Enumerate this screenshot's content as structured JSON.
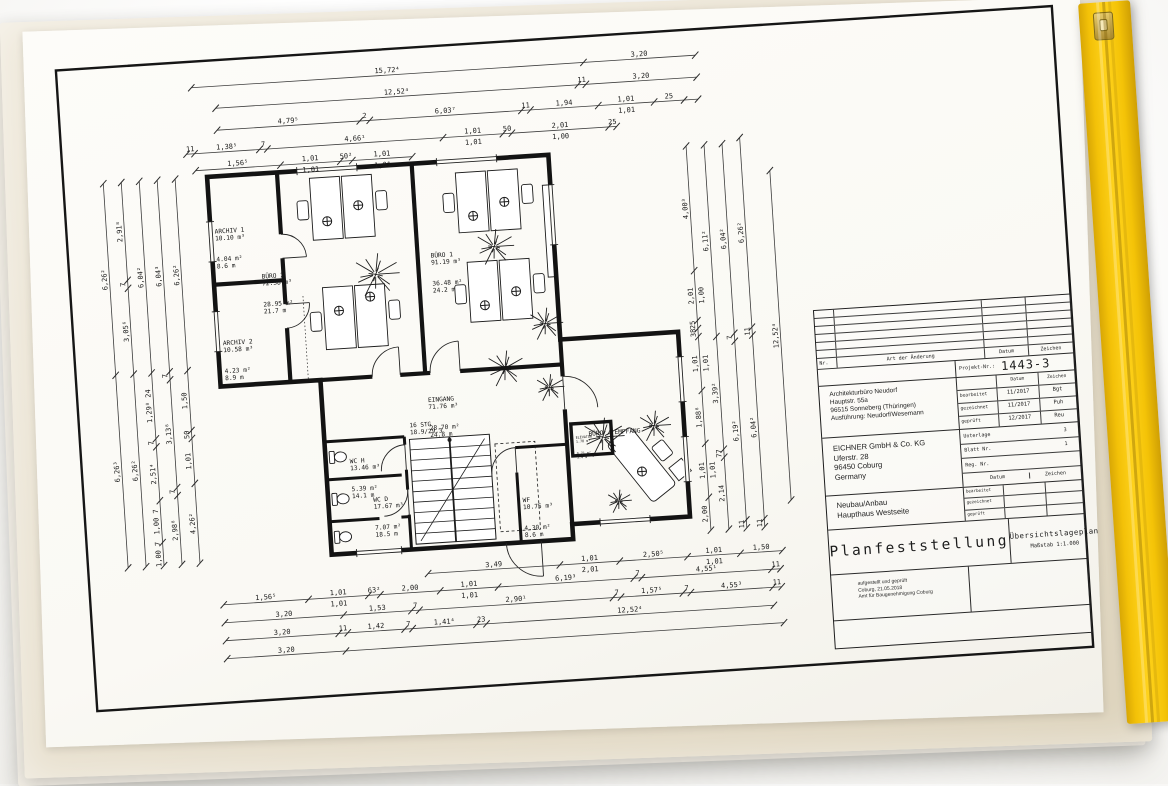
{
  "photo": {
    "background_color": "#ffffff",
    "sleeve_color": "#e7dfcd",
    "sheet_color": "#fbfaf6",
    "binder_strip_color": "#f5c408",
    "line_color": "#1c1c1c"
  },
  "rooms": {
    "archiv1": {
      "lines": [
        "ARCHIV 1",
        "10.10 m³",
        "4.04 m²",
        "8.6 m"
      ]
    },
    "buero2": {
      "lines": [
        "BÜRO 2",
        "72.38 m³",
        "28.95 m²",
        "21.7 m"
      ]
    },
    "archiv2": {
      "lines": [
        "ARCHIV 2",
        "10.58 m³",
        "4.23 m²",
        "8.9 m"
      ]
    },
    "buero1": {
      "lines": [
        "BÜRO 1",
        "91.19 m³",
        "36.48 m²",
        "24.2 m"
      ]
    },
    "eingang": {
      "lines": [
        "EINGANG",
        "71.76 m³",
        "28.70 m²",
        "24.8 m"
      ]
    },
    "wch": {
      "lines": [
        "WC H",
        "13.46 m³",
        "5.39 m²",
        "14.1 m"
      ]
    },
    "wcd": {
      "lines": [
        "WC D",
        "17.67 m³",
        "7.07 m²",
        "18.5 m"
      ]
    },
    "wf": {
      "lines": [
        "WF",
        "10.75 m³",
        "4.30 m²",
        "8.6 m"
      ]
    },
    "empfang": {
      "lines": [
        "BÜRO / EMPFANG"
      ]
    },
    "stairs": {
      "lines": [
        "16 STG",
        "18.9/29.3"
      ]
    },
    "elevator": {
      "lines": [
        "ELEVATOR",
        "1.78 m³",
        "0.71 m²",
        "3.4 m"
      ]
    }
  },
  "dimensions": {
    "t1": [
      "15,72⁴",
      "3,20"
    ],
    "t2": [
      "12,52⁴",
      "11",
      "3,20"
    ],
    "t3": [
      "4,79⁵",
      "2",
      "6,03⁷",
      "11",
      "1,94",
      "1,01|1,01",
      "25",
      ""
    ],
    "t4": [
      "11",
      "1,38⁵",
      "7",
      "4,66¹",
      "1,01|1,01",
      "50",
      "2,01|1,00",
      "25"
    ],
    "t5": [
      "1,56⁵",
      "1,01|1,01",
      "50²",
      "1,01|1,01"
    ],
    "b1": [
      "3,49",
      "1,01|2,01",
      "2,50⁵",
      "1,01|1,01",
      "1,50"
    ],
    "b2": [
      "1,56⁵",
      "1,01|1,01",
      "63²",
      "2,00",
      "1,01|1,01",
      "6,19³",
      "7",
      "4,55¹",
      "11"
    ],
    "b3": [
      "3,20",
      "1,53",
      "7",
      "2,90¹",
      "7",
      "1,57⁵",
      "7",
      "4,55³",
      "11"
    ],
    "b4": [
      "3,20",
      "11",
      "1,42",
      "7",
      "1,41⁴",
      "23",
      "12,52⁴"
    ],
    "b5": [
      "3,20",
      ""
    ],
    "l1": [
      "6,26²",
      "6,26³"
    ],
    "l2": [
      "2,91⁸",
      "7",
      "3,05⁶",
      "6,26²"
    ],
    "l3": [
      "6,04²",
      "1,29⁸ 24",
      "7",
      "2,51⁴",
      "1,00 7",
      "1,00 7"
    ],
    "l4": [
      "6,04³",
      "7",
      "3,13⁸",
      "7",
      "2,98⁸"
    ],
    "l5": [
      "6,26²",
      "1,50",
      "50",
      "1,01",
      "4,26²"
    ],
    "r1": [
      "4,00³",
      "2,01|1,00",
      "25",
      "38",
      "1,01|1,01",
      "1,88⁸",
      "1,01|1,01",
      "2,00"
    ],
    "r2": [
      "6,11²",
      "3,39²",
      "77",
      "2,14"
    ],
    "r3": [
      "6,04²",
      "7",
      "6,19²",
      "11"
    ],
    "r4": [
      "6,26²",
      "11",
      "6,04²",
      "11"
    ],
    "r5": [
      "12,52⁴"
    ]
  },
  "tb": {
    "rev": {
      "nr": "Nr.",
      "art": "Art der Änderung",
      "datum": "Datum",
      "zeichen": "Zeichen"
    },
    "projekt_label": "Projekt-Nr.:",
    "projekt_nr": "1443-3",
    "architect": [
      "Architekturbüro Neudorf",
      "Hauptstr. 55a",
      "96515 Sonneberg (Thüringen)",
      "Ausführung: Neudorf/Wesemann"
    ],
    "sig": {
      "datum": "Datum",
      "zeichen": "Zeichen",
      "rows": [
        {
          "label": "bearbeitet",
          "datum": "11/2017",
          "zeichen": "Bgt"
        },
        {
          "label": "gezeichnet",
          "datum": "11/2017",
          "zeichen": "Puh"
        },
        {
          "label": "geprüft",
          "datum": "12/2017",
          "zeichen": "Reu"
        }
      ]
    },
    "client": [
      "EICHNER GmbH & Co. KG",
      "Uferstr. 28",
      "96450 Coburg",
      "Germany"
    ],
    "doc": {
      "unterlage_label": "Unterlage",
      "unterlage_value": "3",
      "blatt_label": "Blatt Nr.",
      "blatt_value": "1",
      "reg_label": "Reg. Nr.",
      "reg_value": "",
      "datum": "Datum",
      "zeichen": "Zeichen"
    },
    "project": [
      "Neubau/Anbau",
      "Haupthaus Westseite"
    ],
    "mini": [
      "bearbeitet",
      "gezeichnet",
      "geprüft"
    ],
    "main_title": "Planfeststellung",
    "plan_type": "Übersichtslageplan",
    "massstab": "Maßstab  1:1.000",
    "approval": [
      "aufgestellt und geprüft",
      "Coburg, 21.05.2018",
      "Amt für Baugenehmigung Coburg"
    ]
  }
}
